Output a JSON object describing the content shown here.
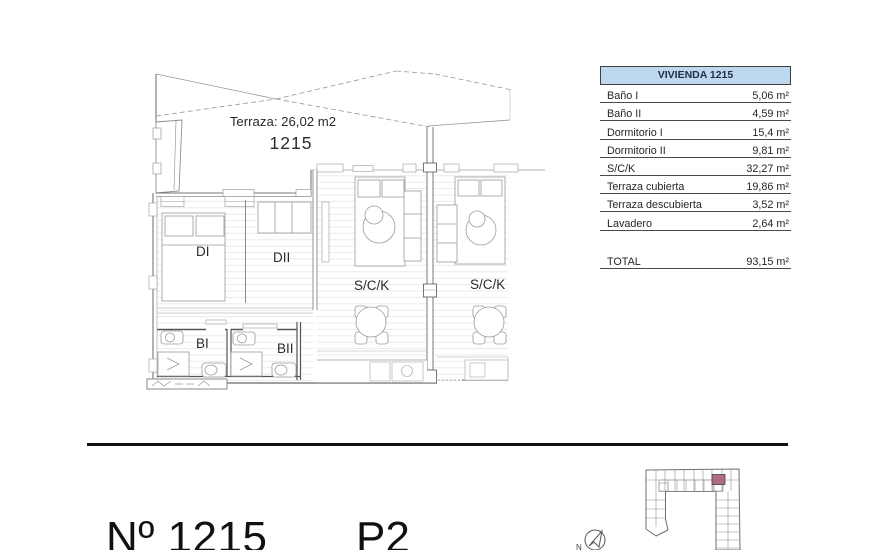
{
  "colors": {
    "accent_red": "#c62a2a",
    "table_header_bg": "#bdd7ee",
    "keyplan_highlight": "#b16b85"
  },
  "floor_plan": {
    "terrace_label": "Terraza: 26,02 m2",
    "unit_number": "1215",
    "room_labels": {
      "dormitorio1": "DI",
      "dormitorio2": "DII",
      "bano1": "BI",
      "bano2": "BII",
      "salon": "S/C/K",
      "salon_neighbor": "S/C/K"
    }
  },
  "area_table": {
    "header": "VIVIENDA 1215",
    "rows": [
      {
        "label": "Baño I",
        "value": "5,06 m²"
      },
      {
        "label": "Baño II",
        "value": "4,59 m²"
      },
      {
        "label": "Dormitorio I",
        "value": "15,4 m²"
      },
      {
        "label": "Dormitorio II",
        "value": "9,81 m²"
      },
      {
        "label": "S/C/K",
        "value": "32,27 m²"
      },
      {
        "label": "Terraza cubierta",
        "value": "19,86 m²"
      },
      {
        "label": "Terraza descubierta",
        "value": "3,52 m²"
      },
      {
        "label": "Lavadero",
        "value": "2,64 m²"
      }
    ],
    "total": {
      "label": "TOTAL",
      "value": "93,15 m²"
    }
  },
  "footer": {
    "unit_title": "Nº 1215",
    "floor": "P2",
    "north_label": "N"
  }
}
